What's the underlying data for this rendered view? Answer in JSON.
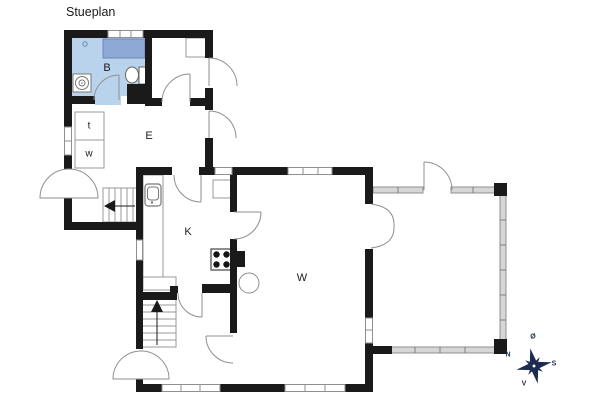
{
  "title": "Stueplan",
  "rooms": [
    {
      "id": "B",
      "label": "B",
      "name": "bathroom"
    },
    {
      "id": "E",
      "label": "E",
      "name": "entry-hall"
    },
    {
      "id": "K",
      "label": "K",
      "name": "kitchen"
    },
    {
      "id": "W",
      "label": "W",
      "name": "living-room"
    },
    {
      "id": "t",
      "label": "t",
      "name": "toilet-closet"
    },
    {
      "id": "w",
      "label": "w",
      "name": "wardrobe-closet"
    }
  ],
  "compass": {
    "north": "N",
    "east": "Ø",
    "south": "S",
    "west": "V"
  },
  "colors": {
    "wall": "#1a1a1a",
    "outline": "#8f8f8f",
    "bath_floor": "#b9d3ec",
    "bath_fixture": "#8fa9d6",
    "bath_fixture_edge": "#6b87b8",
    "glass_wall": "#d6d6d6",
    "compass": "#1c2b4f"
  }
}
